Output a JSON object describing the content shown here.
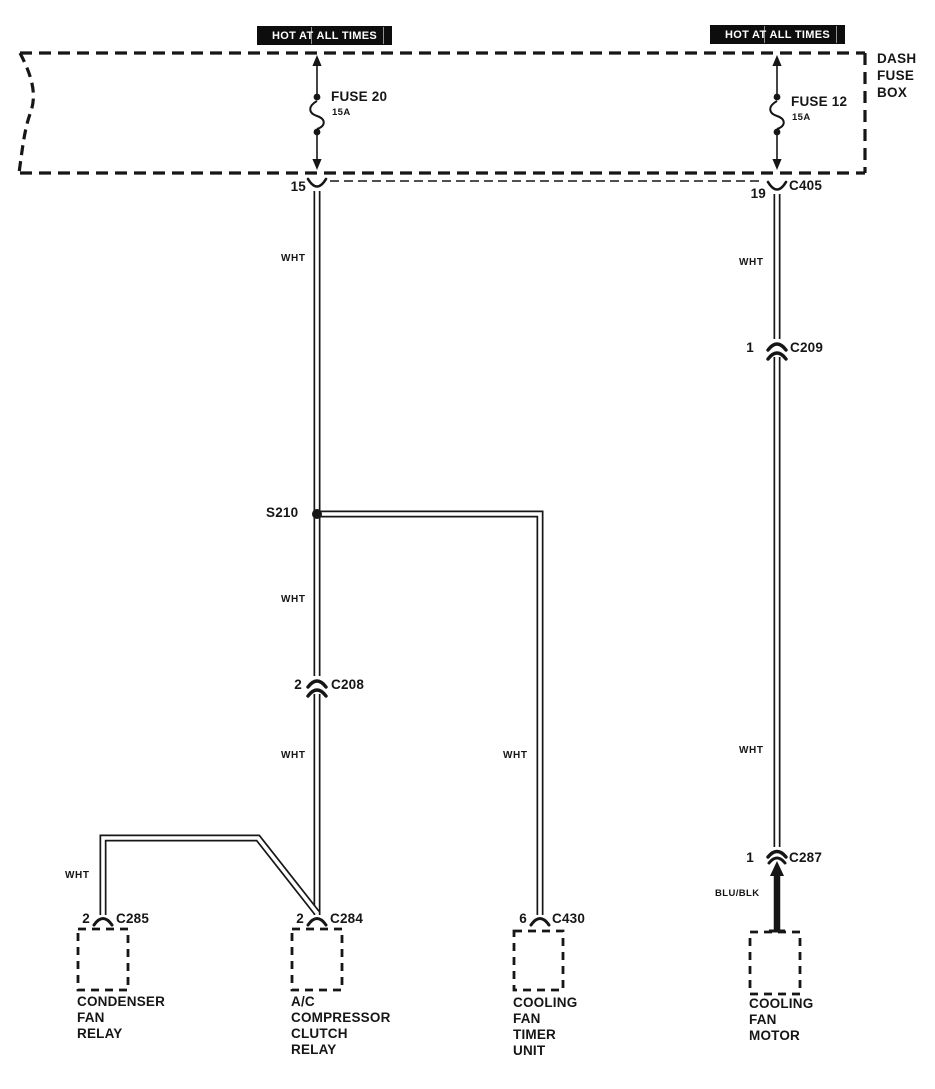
{
  "colors": {
    "background": "#ffffff",
    "line": "#161616",
    "banner_bg": "#0d0d0d",
    "banner_text": "#ffffff"
  },
  "banners": [
    {
      "text": "HOT AT ALL TIMES"
    },
    {
      "text": "HOT AT ALL TIMES"
    }
  ],
  "fuse_box": {
    "label": "DASH\nFUSE\nBOX"
  },
  "fuses": [
    {
      "name": "FUSE 20",
      "rating": "15A"
    },
    {
      "name": "FUSE 12",
      "rating": "15A"
    }
  ],
  "connectors": [
    {
      "pin": "15",
      "id": ""
    },
    {
      "pin": "19",
      "id": "C405"
    },
    {
      "pin": "1",
      "id": "C209"
    },
    {
      "id": "S210"
    },
    {
      "pin": "2",
      "id": "C208"
    },
    {
      "pin": "2",
      "id": "C285"
    },
    {
      "pin": "2",
      "id": "C284"
    },
    {
      "pin": "6",
      "id": "C430"
    },
    {
      "pin": "1",
      "id": "C287"
    }
  ],
  "wire_labels": [
    {
      "text": "WHT",
      "wire": "left-upper"
    },
    {
      "text": "WHT",
      "wire": "left-middle"
    },
    {
      "text": "WHT",
      "wire": "left-lower"
    },
    {
      "text": "WHT",
      "wire": "timer-branch"
    },
    {
      "text": "WHT",
      "wire": "right-upper"
    },
    {
      "text": "WHT",
      "wire": "right-lower"
    },
    {
      "text": "WHT",
      "wire": "condenser-branch"
    },
    {
      "text": "BLU/BLK",
      "wire": "motor-feed"
    }
  ],
  "components": [
    {
      "name": "CONDENSER\nFAN\nRELAY"
    },
    {
      "name": "A/C\nCOMPRESSOR\nCLUTCH\nRELAY"
    },
    {
      "name": "COOLING\nFAN\nTIMER\nUNIT"
    },
    {
      "name": "COOLING\nFAN\nMOTOR"
    }
  ]
}
